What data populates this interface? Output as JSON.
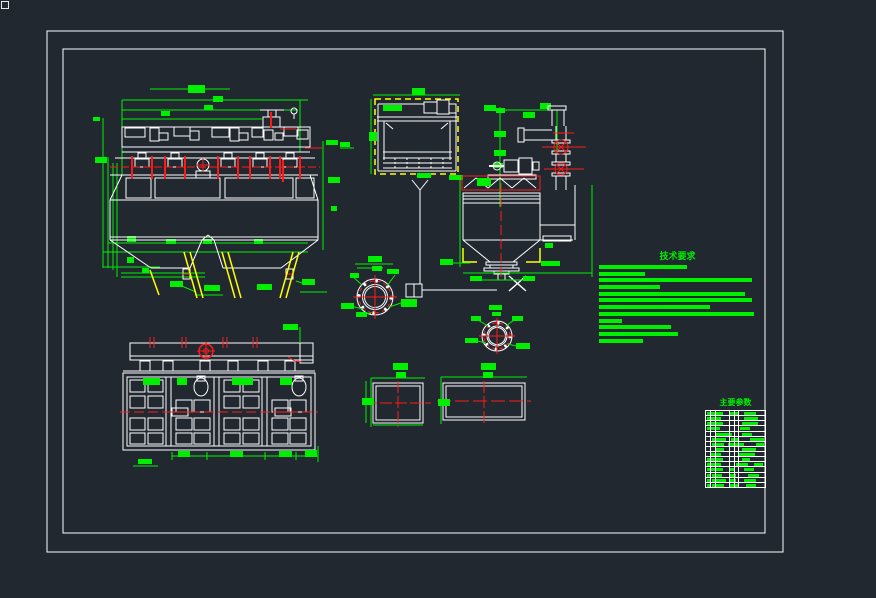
{
  "palette": {
    "background": "#212830",
    "linework_white": "#ffffff",
    "dimension_green": "#00ef00",
    "centerline_red": "#ff1a1a",
    "highlight_yellow": "#ffff00"
  },
  "technical_notes": {
    "title": "技术要求",
    "line_widths": [
      88,
      46,
      153,
      61,
      146,
      153,
      111,
      155,
      23,
      72,
      79,
      44
    ]
  },
  "parts_table": {
    "title": "主要参数",
    "column_offsets": [
      4,
      9,
      23,
      28,
      32
    ],
    "rows": [
      {
        "bars": [
          [
            1,
            3
          ],
          [
            5,
            12
          ],
          [
            24,
            9
          ],
          [
            38,
            12
          ]
        ]
      },
      {
        "bars": [
          [
            1,
            3
          ],
          [
            5,
            10
          ],
          [
            38,
            14
          ]
        ]
      },
      {
        "bars": [
          [
            1,
            3
          ],
          [
            5,
            12
          ],
          [
            36,
            16
          ]
        ]
      },
      {
        "bars": [
          [
            1,
            3
          ],
          [
            5,
            9
          ],
          [
            34,
            10
          ]
        ]
      },
      {
        "bars": [
          [
            10,
            16
          ],
          [
            36,
            10
          ]
        ]
      },
      {
        "bars": [
          [
            6,
            14
          ],
          [
            25,
            8
          ],
          [
            44,
            10
          ],
          [
            54,
            4
          ]
        ]
      },
      {
        "bars": [
          [
            6,
            12
          ],
          [
            22,
            16
          ],
          [
            50,
            8
          ]
        ]
      },
      {
        "bars": [
          [
            10,
            8
          ],
          [
            36,
            14
          ]
        ]
      },
      {
        "bars": [
          [
            5,
            10
          ],
          [
            33,
            16
          ]
        ]
      },
      {
        "bars": [
          [
            1,
            3
          ],
          [
            5,
            12
          ],
          [
            36,
            8
          ]
        ]
      },
      {
        "bars": [
          [
            1,
            3
          ],
          [
            5,
            10
          ],
          [
            30,
            12
          ],
          [
            48,
            9
          ]
        ]
      },
      {
        "bars": [
          [
            1,
            3
          ],
          [
            5,
            12
          ],
          [
            24,
            4
          ],
          [
            38,
            10
          ]
        ]
      },
      {
        "bars": [
          [
            1,
            3
          ],
          [
            6,
            10
          ],
          [
            24,
            6
          ],
          [
            42,
            11
          ]
        ]
      },
      {
        "bars": [
          [
            1,
            3
          ],
          [
            6,
            14
          ],
          [
            24,
            6
          ],
          [
            38,
            12
          ]
        ]
      },
      {
        "bars": [
          [
            1,
            3
          ],
          [
            6,
            12
          ],
          [
            24,
            8
          ],
          [
            40,
            10
          ]
        ]
      }
    ]
  }
}
